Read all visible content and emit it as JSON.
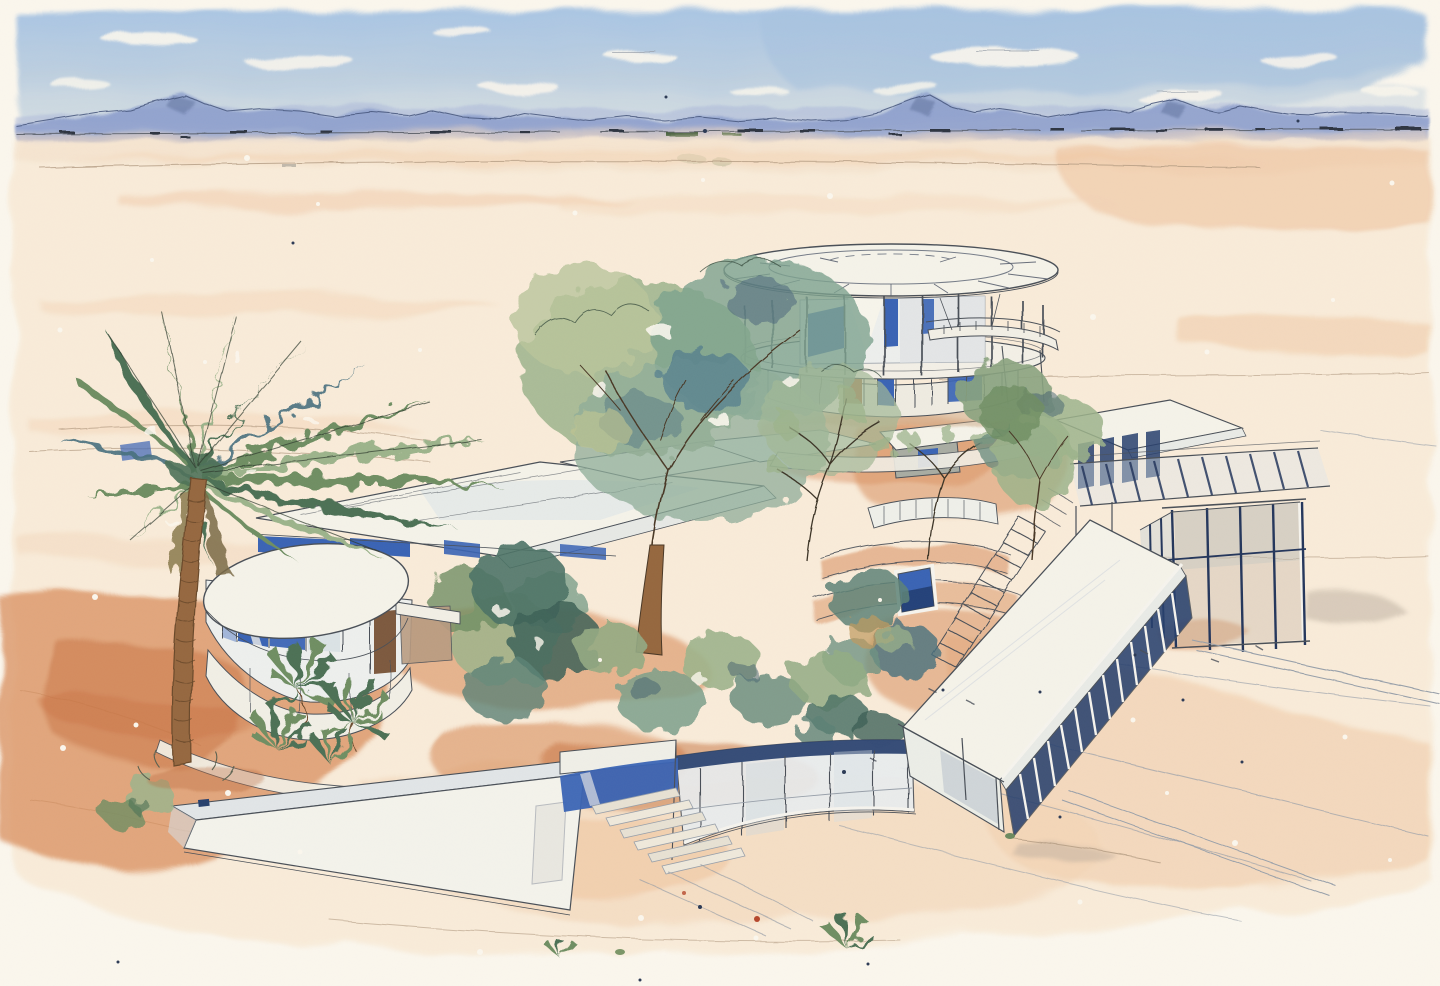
{
  "artwork": {
    "type": "watercolor architectural illustration",
    "subject": "Aerial watercolor sketch of a modernist desert compound: a round two-storey glass pavilion, flat-roofed wings, a glass gallery and long roofed corridor, a curved glazed perimeter wall, courtyard trees and a tall fan palm on an open desert plain with distant blue mountains",
    "medium": "ink line and watercolor wash on paper",
    "orientation": "landscape"
  },
  "palette": {
    "paper": "#fbf7ee",
    "sky_blue": "#a6c2e0",
    "sky_pale": "#ccd9e2",
    "mountain_blue": "#8497cb",
    "mountain_ink": "#45557c",
    "haze_pink": "#edd5c1",
    "sand_light": "#f8e7d0",
    "sand_mid": "#f3d5b6",
    "sand_warm": "#edbe94",
    "terracotta": "#d98f5e",
    "terracotta_deep": "#c66f3e",
    "ink": "#4a5058",
    "ink_soft": "#98a0aa",
    "contour": "#b39b82",
    "roof_white": "#f5f3ea",
    "roof_shadow": "#dfe3e4",
    "glass_pale": "#cfdae1",
    "glass_blue": "#3a64b5",
    "glass_deep": "#27406e",
    "foliage_dark": "#4e7156",
    "foliage_green": "#6f8f63",
    "foliage_sage": "#9db48c",
    "foliage_pale": "#bac69c",
    "foliage_teal": "#48707e",
    "trunk_brown": "#96683f",
    "door_brown": "#a96f3e"
  },
  "scene": {
    "sky": "pale blue wash with white cloud gaps",
    "mountains": "distant blue mountain ridge with ink crest line",
    "desert": "warm sand washes, pen contour lines and paint spatter",
    "compound": {
      "rotunda": "round two-storey glass pavilion with circular roof and ring colonnade",
      "left_wing": "flat-roofed wing with blue clerestory glazing",
      "oval_pavilion": "oval glass pavilion with blue curtain-wall panels",
      "right_pavilion": "flat-roofed pavilion with navy glazing",
      "pergola": "slatted pergola walkway",
      "glass_gallery": "transparent glass box gallery",
      "corridor": "long roofed corridor with dark glazed face",
      "perimeter_wall": "curved glazed perimeter wall with navy cap",
      "ramp_wall": "long white ramp wall",
      "stair": "curved courtyard stair",
      "pool": "small blue plunge pool",
      "steps": "entry steps through wall opening"
    },
    "vegetation": {
      "palm": "tall fan palm",
      "courtyard_tree": "broadleaf courtyard tree",
      "small_palms": "clustered fan palms",
      "shrubs": "desert shrubs and bushes",
      "bare_trees": "bare twiggy saplings"
    }
  }
}
